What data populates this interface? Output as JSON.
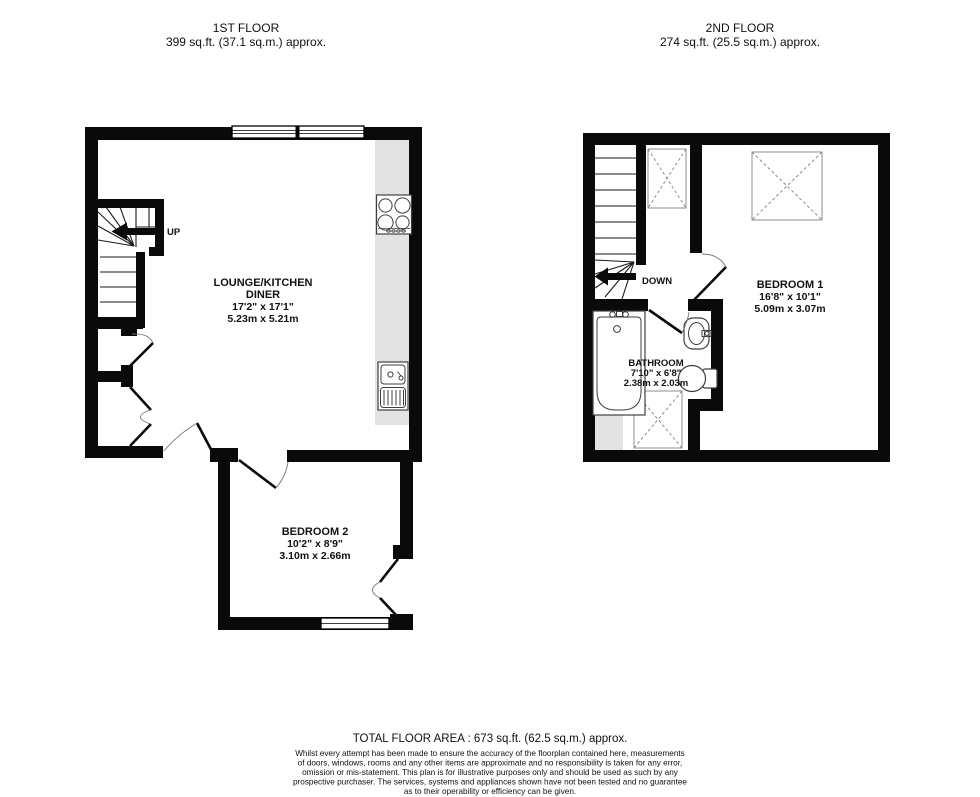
{
  "floors": [
    {
      "title": "1ST FLOOR",
      "area": "399 sq.ft. (37.1 sq.m.) approx."
    },
    {
      "title": "2ND FLOOR",
      "area": "274 sq.ft. (25.5 sq.m.) approx."
    }
  ],
  "rooms": {
    "lounge": {
      "line1": "LOUNGE/KITCHEN",
      "line2": "DINER",
      "ft": "17'2\" x 17'1\"",
      "m": "5.23m x 5.21m"
    },
    "bedroom2": {
      "name": "BEDROOM 2",
      "ft": "10'2\" x 8'9\"",
      "m": "3.10m x 2.66m"
    },
    "bedroom1": {
      "name": "BEDROOM 1",
      "ft": "16'8\" x 10'1\"",
      "m": "5.09m x 3.07m"
    },
    "bathroom": {
      "name": "BATHROOM",
      "ft": "7'10\" x 6'8\"",
      "m": "2.38m x 2.03m"
    }
  },
  "stairs": {
    "up": "UP",
    "down": "DOWN"
  },
  "footer": {
    "total": "TOTAL FLOOR AREA : 673 sq.ft. (62.5 sq.m.) approx.",
    "disclaimer": [
      "Whilst every attempt has been made to ensure the accuracy of the floorplan contained here, measurements",
      "of doors, windows, rooms and any other items are approximate and no responsibility is taken for any error,",
      "omission or mis-statement. This plan is for illustrative purposes only and should be used as such by any",
      "prospective purchaser. The services, systems and appliances shown have not been tested and no guarantee",
      "as to their operability or efficiency can be given."
    ]
  },
  "colors": {
    "wall": "#0a0a0a",
    "counter": "#e3e3e3",
    "fixture": "#3f3f3f",
    "dashed_box": "#8c8c8c"
  }
}
